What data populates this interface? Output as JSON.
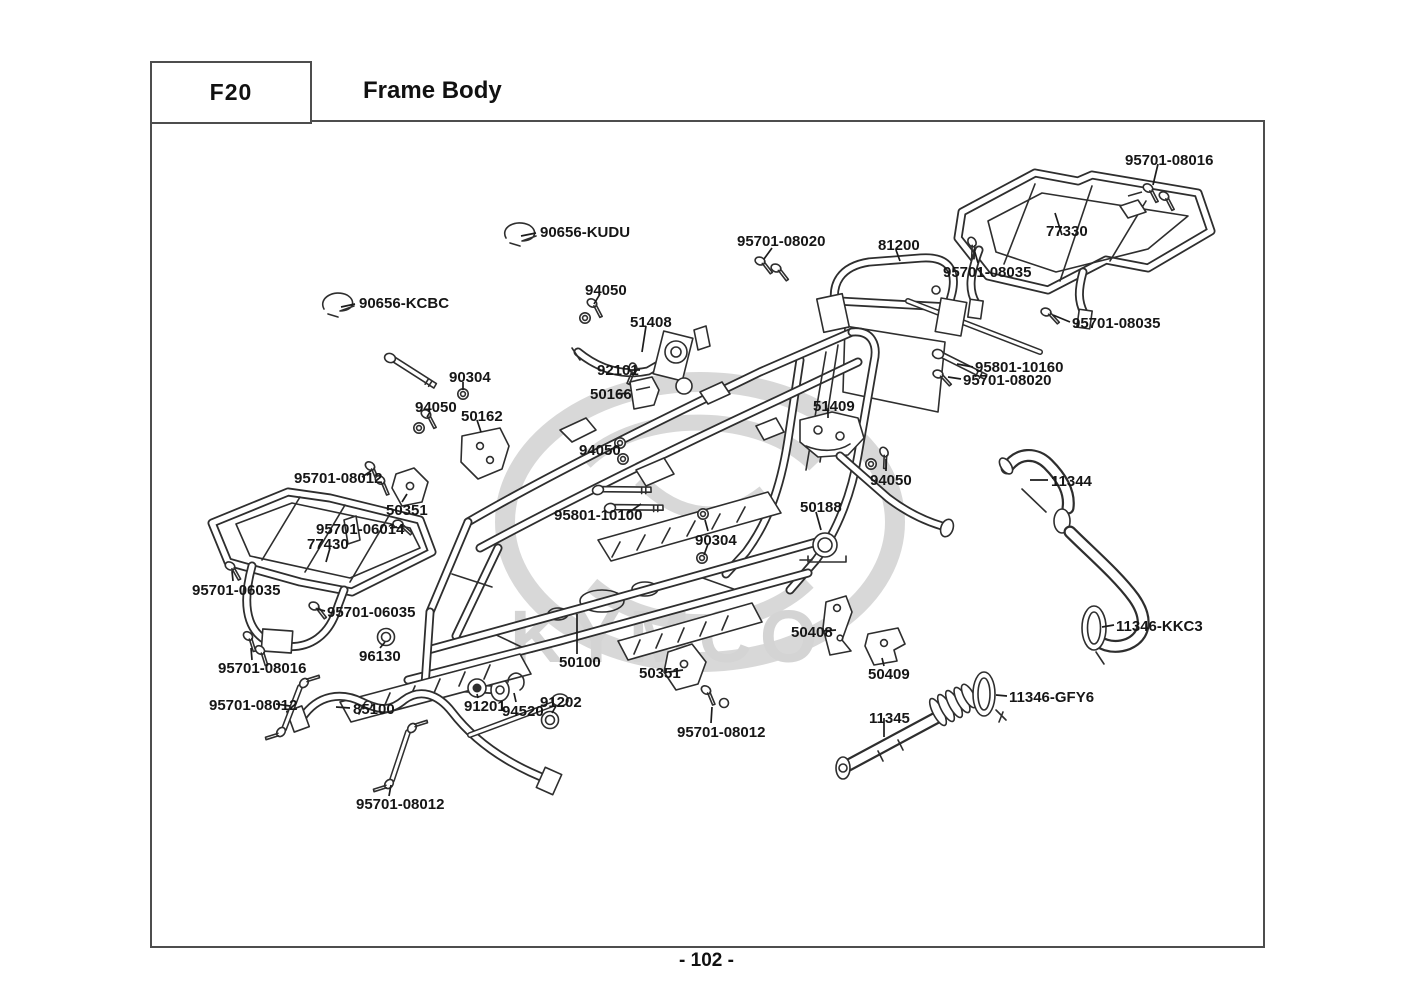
{
  "page": {
    "code": "F20",
    "title": "Frame Body",
    "page_number": "- 102 -"
  },
  "watermark": {
    "text": "KYMCO"
  },
  "diagram": {
    "description": "Exploded parts diagram of ATV frame body with part number callouts",
    "labels": [
      {
        "text": "90656-KUDU",
        "x": 540,
        "y": 225
      },
      {
        "text": "90656-KCBC",
        "x": 359,
        "y": 296
      },
      {
        "text": "94050",
        "x": 585,
        "y": 283
      },
      {
        "text": "51408",
        "x": 630,
        "y": 315
      },
      {
        "text": "92101",
        "x": 597,
        "y": 363
      },
      {
        "text": "50166",
        "x": 590,
        "y": 387
      },
      {
        "text": "90304",
        "x": 449,
        "y": 370
      },
      {
        "text": "94050",
        "x": 415,
        "y": 400
      },
      {
        "text": "50162",
        "x": 461,
        "y": 409
      },
      {
        "text": "95701-08012",
        "x": 294,
        "y": 471
      },
      {
        "text": "50351",
        "x": 386,
        "y": 503
      },
      {
        "text": "95701-06014",
        "x": 316,
        "y": 522
      },
      {
        "text": "77430",
        "x": 307,
        "y": 537
      },
      {
        "text": "95701-06035",
        "x": 192,
        "y": 583
      },
      {
        "text": "95701-06035",
        "x": 327,
        "y": 605
      },
      {
        "text": "96130",
        "x": 359,
        "y": 649
      },
      {
        "text": "95701-08016",
        "x": 218,
        "y": 661
      },
      {
        "text": "95701-08012",
        "x": 209,
        "y": 698
      },
      {
        "text": "85100",
        "x": 353,
        "y": 702
      },
      {
        "text": "95701-08012",
        "x": 356,
        "y": 797
      },
      {
        "text": "91201",
        "x": 464,
        "y": 699
      },
      {
        "text": "94520",
        "x": 502,
        "y": 704
      },
      {
        "text": "91202",
        "x": 540,
        "y": 695
      },
      {
        "text": "50100",
        "x": 559,
        "y": 655
      },
      {
        "text": "50351",
        "x": 639,
        "y": 666
      },
      {
        "text": "95701-08012",
        "x": 677,
        "y": 725
      },
      {
        "text": "95801-10100",
        "x": 554,
        "y": 508
      },
      {
        "text": "94050",
        "x": 579,
        "y": 443
      },
      {
        "text": "90304",
        "x": 695,
        "y": 533
      },
      {
        "text": "50188",
        "x": 800,
        "y": 500
      },
      {
        "text": "51409",
        "x": 813,
        "y": 399
      },
      {
        "text": "94050",
        "x": 870,
        "y": 473
      },
      {
        "text": "95701-08020",
        "x": 737,
        "y": 234
      },
      {
        "text": "81200",
        "x": 878,
        "y": 238
      },
      {
        "text": "95701-08035",
        "x": 943,
        "y": 265
      },
      {
        "text": "77330",
        "x": 1046,
        "y": 224
      },
      {
        "text": "95701-08016",
        "x": 1125,
        "y": 153
      },
      {
        "text": "95701-08035",
        "x": 1072,
        "y": 316
      },
      {
        "text": "95801-10160",
        "x": 975,
        "y": 360
      },
      {
        "text": "95701-08020",
        "x": 963,
        "y": 373
      },
      {
        "text": "11344",
        "x": 1051,
        "y": 474
      },
      {
        "text": "11346-KKC3",
        "x": 1116,
        "y": 619
      },
      {
        "text": "50408",
        "x": 791,
        "y": 625
      },
      {
        "text": "50409",
        "x": 868,
        "y": 667
      },
      {
        "text": "11346-GFY6",
        "x": 1009,
        "y": 690
      },
      {
        "text": "11345",
        "x": 869,
        "y": 711
      }
    ]
  },
  "colors": {
    "line": "#2e2e2e",
    "border": "#4d4d4d",
    "label": "#161616",
    "watermark": "#d6d6d6",
    "background": "#ffffff"
  }
}
